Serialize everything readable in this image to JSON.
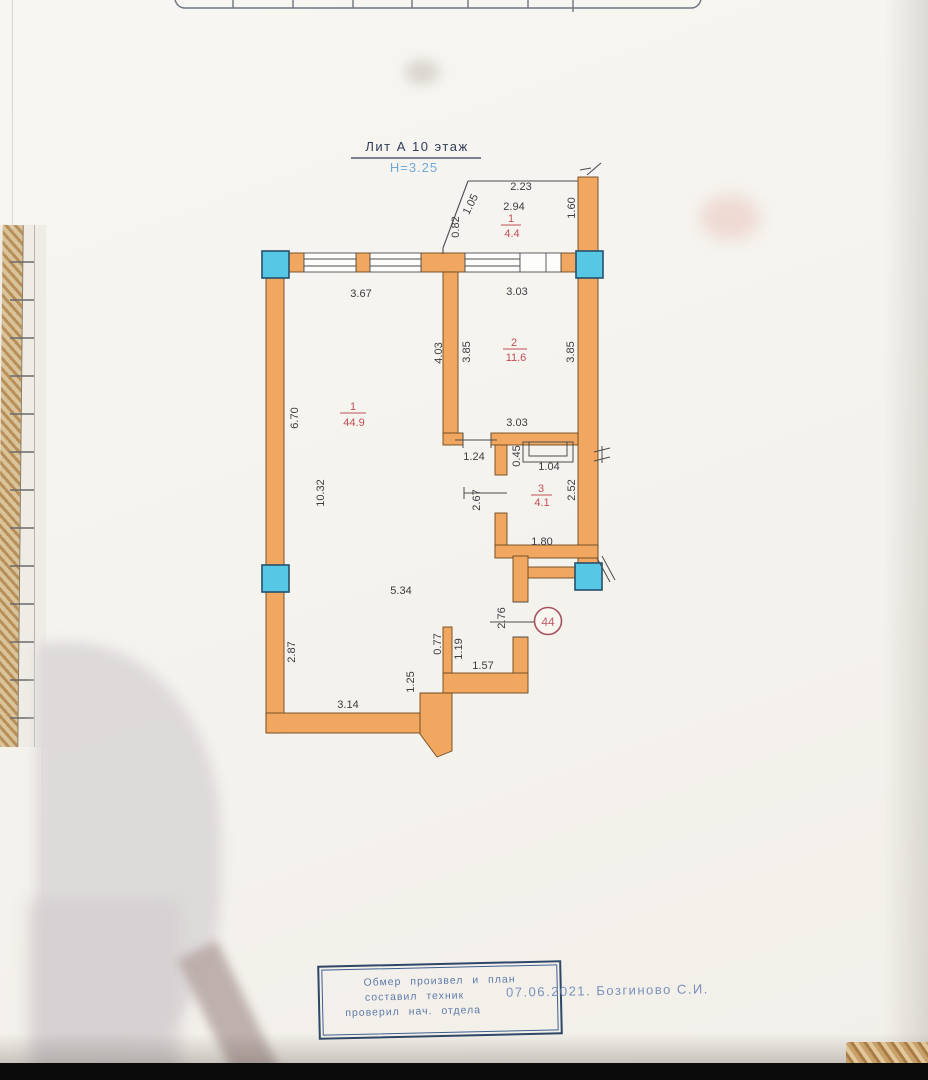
{
  "title": {
    "liter": "Лит А 10 этаж",
    "height_note": "Н=3.25"
  },
  "apartment_number": "44",
  "rooms": {
    "balcony": {
      "num": "1",
      "area": "4.4"
    },
    "room2": {
      "num": "2",
      "area": "11.6"
    },
    "living": {
      "num": "1",
      "area": "44.9"
    },
    "bath": {
      "num": "3",
      "area": "4.1"
    }
  },
  "dims": {
    "d2_23": "2.23",
    "d2_94": "2.94",
    "d1_05": "1.05",
    "d0_82": "0.82",
    "d1_60": "1.60",
    "d3_67": "3.67",
    "d3_03_top": "3.03",
    "d4_03": "4.03",
    "d3_85_l": "3.85",
    "d3_85_r": "3.85",
    "d6_70": "6.70",
    "d10_32": "10.32",
    "d3_03_mid": "3.03",
    "d1_24": "1.24",
    "d0_45": "0.45",
    "d1_04": "1.04",
    "d2_67": "2.67",
    "d2_52": "2.52",
    "d1_80": "1.80",
    "d5_34": "5.34",
    "d2_76": "2.76",
    "d2_87": "2.87",
    "d0_77": "0.77",
    "d1_19": "1.19",
    "d1_57": "1.57",
    "d1_25": "1.25",
    "d3_14": "3.14"
  },
  "stamp": {
    "line1": "Обмер произвел и план",
    "line2": "составил техник",
    "line3": "проверил нач. отдела",
    "date_and_name": "07.06.2021. Бозгиново С.И."
  },
  "colors": {
    "wall_fill": "#f1a75f",
    "column_fill": "#57c7e6",
    "room_label_red": "#c14f58",
    "height_note_blue": "#6fa9d8",
    "stamp_blue": "#3f5f92"
  }
}
